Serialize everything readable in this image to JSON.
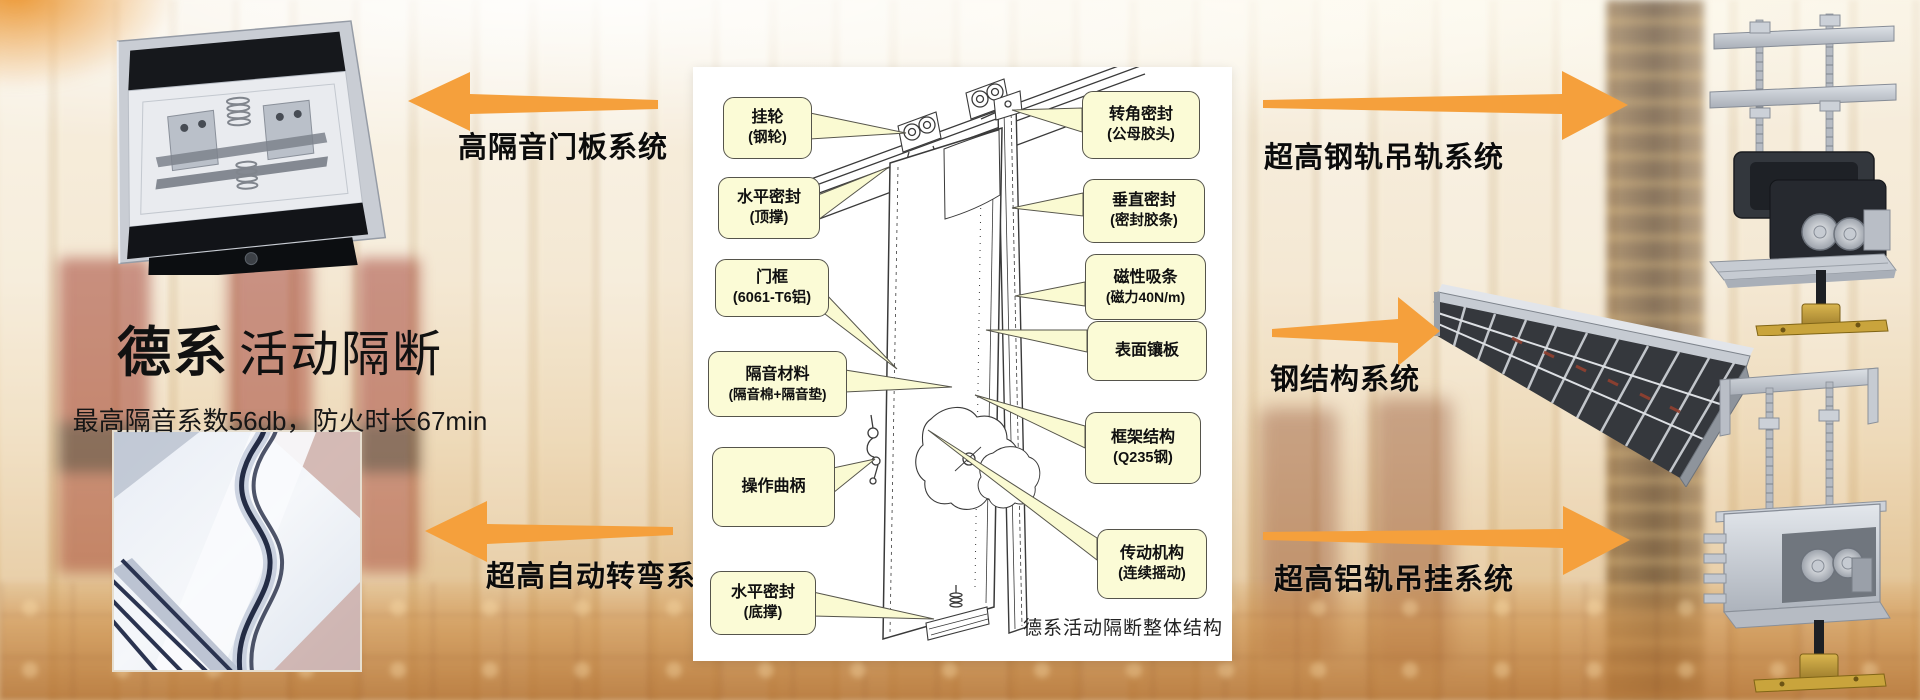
{
  "hero": {
    "brand_bold": "德系",
    "brand_rest": "活动隔断",
    "subtitle": "最高隔音系数56db，防火时长67min"
  },
  "arrows": {
    "top_left": {
      "label": "高隔音门板系统",
      "direction": "left"
    },
    "bottom_left": {
      "label": "超高自动转弯系统",
      "direction": "left"
    },
    "top_right": {
      "label": "超高钢轨吊轨系统",
      "direction": "right"
    },
    "middle_right": {
      "label": "钢结构系统",
      "direction": "right"
    },
    "bottom_right": {
      "label": "超高铝轨吊挂系统",
      "direction": "right"
    }
  },
  "diagram": {
    "caption": "德系活动隔断整体结构",
    "callouts_left": [
      {
        "line1": "挂轮",
        "line2": "(钢轮)"
      },
      {
        "line1": "水平密封",
        "line2": "(顶撑)"
      },
      {
        "line1": "门框",
        "line2": "(6061-T6铝)"
      },
      {
        "line1": "隔音材料",
        "line2": "(隔音棉+隔音垫)"
      },
      {
        "line1": "操作曲柄",
        "line2": ""
      },
      {
        "line1": "水平密封",
        "line2": "(底撑)"
      }
    ],
    "callouts_right": [
      {
        "line1": "转角密封",
        "line2": "(公母胶头)"
      },
      {
        "line1": "垂直密封",
        "line2": "(密封胶条)"
      },
      {
        "line1": "磁性吸条",
        "line2": "(磁力40N/m)"
      },
      {
        "line1": "表面镶板",
        "line2": ""
      },
      {
        "line1": "框架结构",
        "line2": "(Q235钢)"
      },
      {
        "line1": "传动机构",
        "line2": "(连续摇动)"
      }
    ]
  },
  "colors": {
    "arrow_orange": "#F5A03C",
    "callout_bg": "#FBFBD6",
    "callout_border": "#55544B",
    "panel_bg": "#FFFFFF",
    "text_black": "#111111"
  }
}
